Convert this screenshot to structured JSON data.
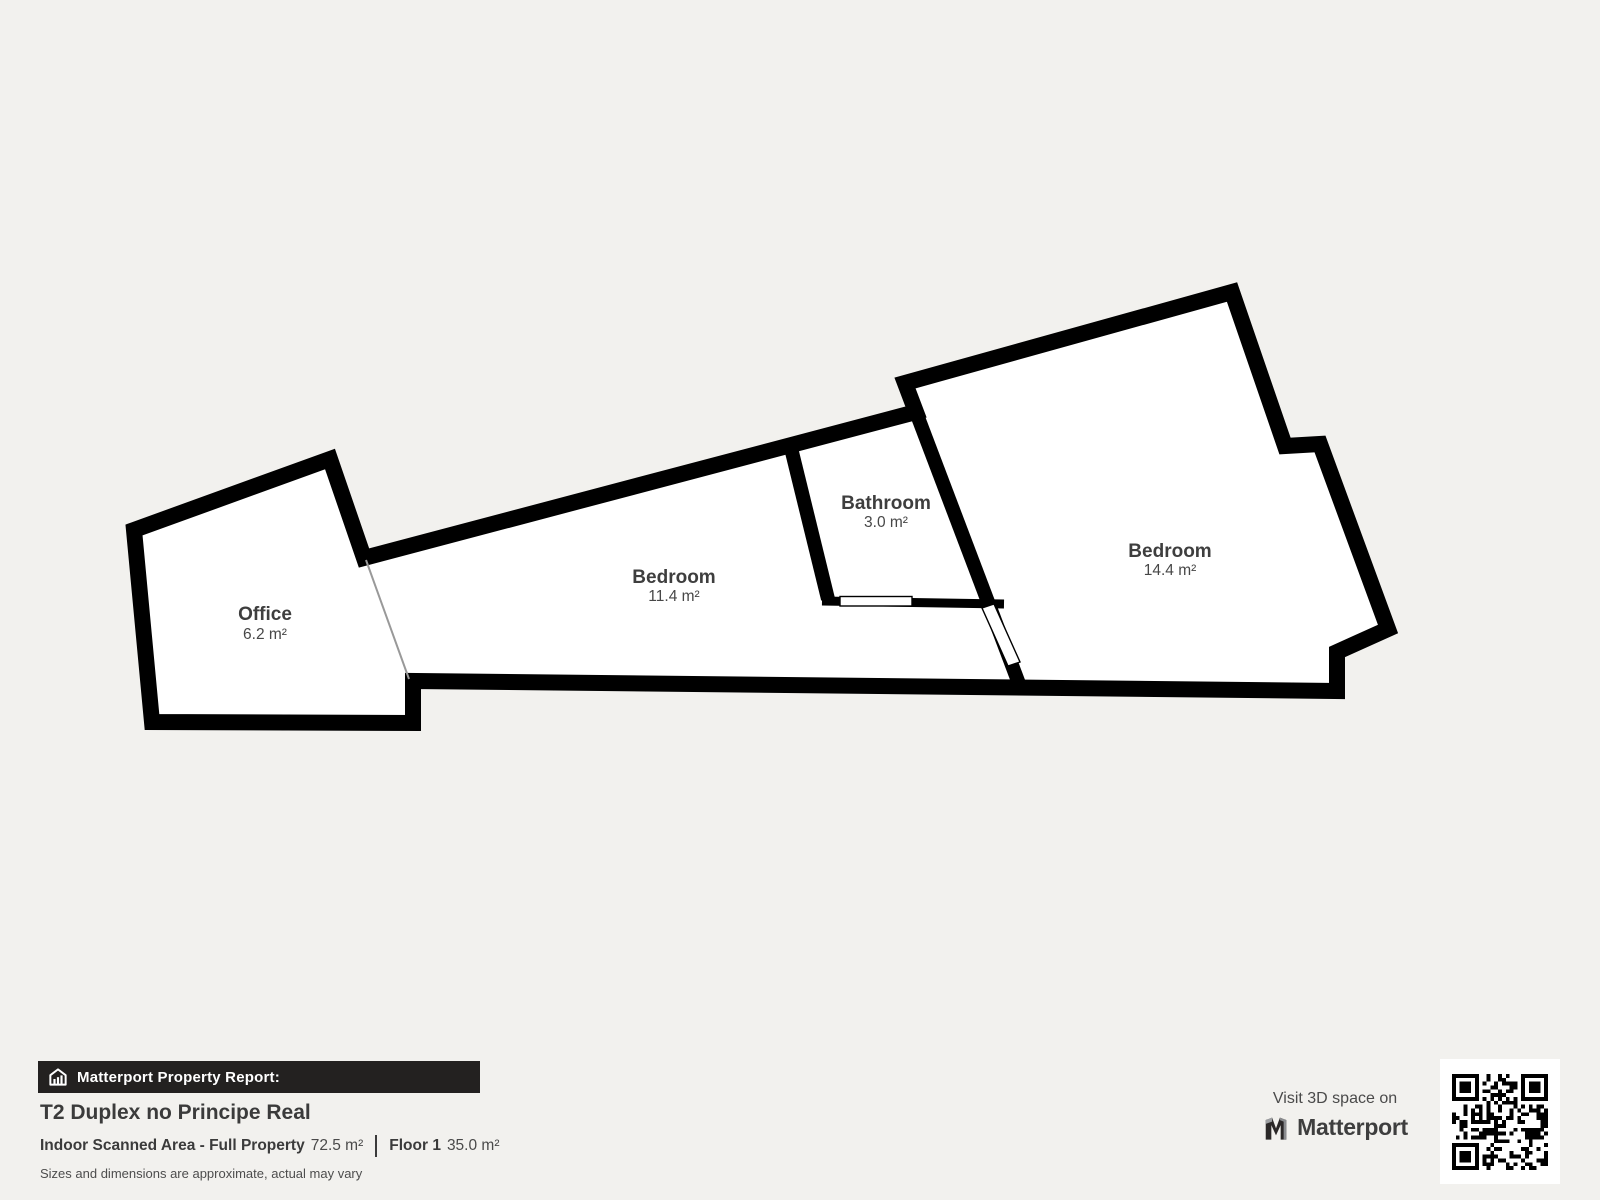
{
  "colors": {
    "background": "#f2f1ee",
    "wall": "#000000",
    "room_fill": "#ffffff",
    "bar_background": "#232120",
    "text_dark": "#3b3b3b"
  },
  "rooms": [
    {
      "name": "Office",
      "area": "6.2 m²"
    },
    {
      "name": "Bedroom",
      "area": "11.4 m²"
    },
    {
      "name": "Bathroom",
      "area": "3.0 m²"
    },
    {
      "name": "Bedroom",
      "area": "14.4 m²"
    }
  ],
  "report": {
    "bar_label": "Matterport Property Report:",
    "title": "T2 Duplex no Principe Real",
    "scanned_area_label": "Indoor Scanned Area - Full Property",
    "scanned_area_value": "72.5 m²",
    "floor_label": "Floor 1",
    "floor_value": "35.0 m²",
    "disclaimer": "Sizes and dimensions are approximate, actual may vary"
  },
  "cta": {
    "line": "Visit 3D space on",
    "brand": "Matterport"
  },
  "icons": {
    "report_bar": "house-bars-icon",
    "brand": "matterport-m-icon",
    "qr": "qr-code"
  }
}
